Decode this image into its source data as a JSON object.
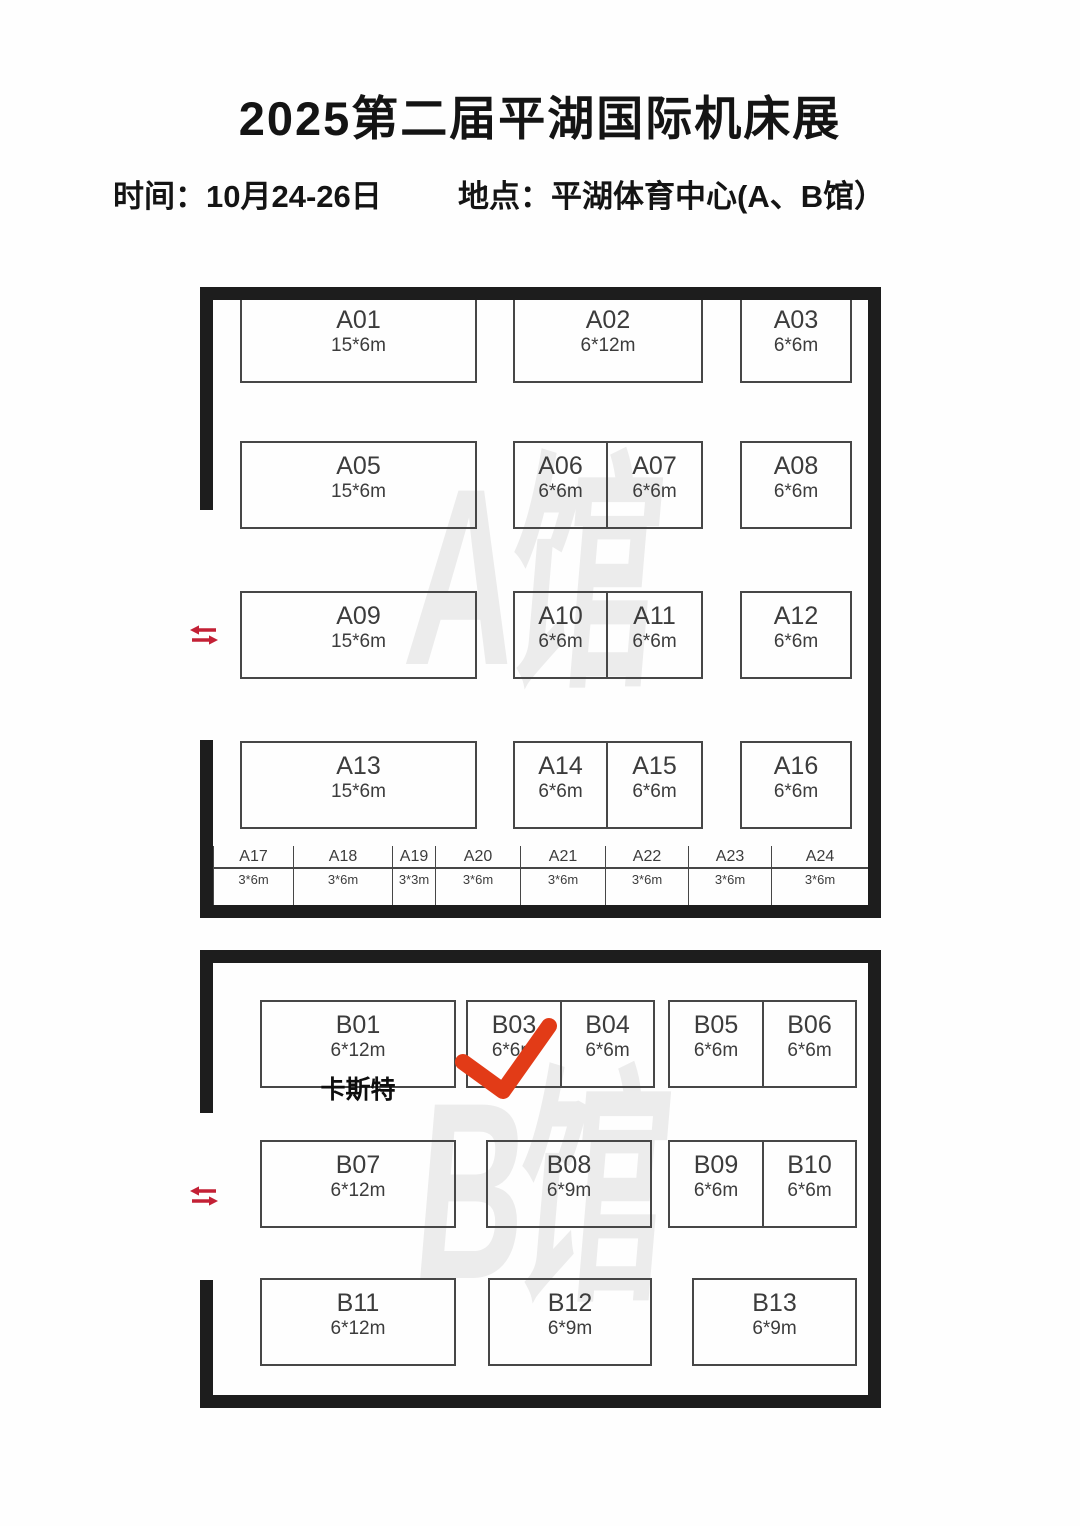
{
  "title": "2025第二届平湖国际机床展",
  "info": {
    "time": "时间：10月24-26日",
    "location": "地点：平湖体育中心(A、B馆）"
  },
  "colors": {
    "wall": "#1d1d1d",
    "booth_border": "#474747",
    "booth_text": "#3c3c3c",
    "watermark": "#ececec",
    "entrance_arrows": "#c32035",
    "checkmark": "#e23b17"
  },
  "annotations": {
    "checkmark_on_booth": "B03",
    "entrance_icon": "two-way-arrows"
  },
  "halls": [
    {
      "name": "A馆",
      "watermark": "A馆",
      "booths": [
        {
          "name": "A01",
          "size": "15*6m",
          "x": 240,
          "y": 295,
          "w": 237,
          "h": 88
        },
        {
          "name": "A02",
          "size": "6*12m",
          "x": 513,
          "y": 295,
          "w": 190,
          "h": 88
        },
        {
          "name": "A03",
          "size": "6*6m",
          "x": 740,
          "y": 295,
          "w": 112,
          "h": 88
        },
        {
          "name": "A05",
          "size": "15*6m",
          "x": 240,
          "y": 441,
          "w": 237,
          "h": 88
        },
        {
          "name": "A06",
          "size": "6*6m",
          "x": 513,
          "y": 441,
          "w": 95,
          "h": 88
        },
        {
          "name": "A07",
          "size": "6*6m",
          "x": 606,
          "y": 441,
          "w": 97,
          "h": 88
        },
        {
          "name": "A08",
          "size": "6*6m",
          "x": 740,
          "y": 441,
          "w": 112,
          "h": 88
        },
        {
          "name": "A09",
          "size": "15*6m",
          "x": 240,
          "y": 591,
          "w": 237,
          "h": 88
        },
        {
          "name": "A10",
          "size": "6*6m",
          "x": 513,
          "y": 591,
          "w": 95,
          "h": 88
        },
        {
          "name": "A11",
          "size": "6*6m",
          "x": 606,
          "y": 591,
          "w": 97,
          "h": 88
        },
        {
          "name": "A12",
          "size": "6*6m",
          "x": 740,
          "y": 591,
          "w": 112,
          "h": 88
        },
        {
          "name": "A13",
          "size": "15*6m",
          "x": 240,
          "y": 741,
          "w": 237,
          "h": 88
        },
        {
          "name": "A14",
          "size": "6*6m",
          "x": 513,
          "y": 741,
          "w": 95,
          "h": 88
        },
        {
          "name": "A15",
          "size": "6*6m",
          "x": 606,
          "y": 741,
          "w": 97,
          "h": 88
        },
        {
          "name": "A16",
          "size": "6*6m",
          "x": 740,
          "y": 741,
          "w": 112,
          "h": 88
        }
      ],
      "strip_booths": [
        {
          "name": "A17",
          "size": "3*6m",
          "x": 213,
          "w": 80
        },
        {
          "name": "A18",
          "size": "3*6m",
          "x": 293,
          "w": 99
        },
        {
          "name": "A19",
          "size": "3*3m",
          "x": 392,
          "w": 43
        },
        {
          "name": "A20",
          "size": "3*6m",
          "x": 435,
          "w": 85
        },
        {
          "name": "A21",
          "size": "3*6m",
          "x": 520,
          "w": 85
        },
        {
          "name": "A22",
          "size": "3*6m",
          "x": 605,
          "w": 83
        },
        {
          "name": "A23",
          "size": "3*6m",
          "x": 688,
          "w": 83
        },
        {
          "name": "A24",
          "size": "3*6m",
          "x": 771,
          "w": 97
        }
      ]
    },
    {
      "name": "B馆",
      "watermark": "B馆",
      "booths": [
        {
          "name": "B01",
          "size": "6*12m",
          "exhibitor": "卡斯特",
          "x": 260,
          "y": 1000,
          "w": 196,
          "h": 88
        },
        {
          "name": "B03",
          "size": "6*6m",
          "x": 466,
          "y": 1000,
          "w": 96,
          "h": 88
        },
        {
          "name": "B04",
          "size": "6*6m",
          "x": 560,
          "y": 1000,
          "w": 95,
          "h": 88
        },
        {
          "name": "B05",
          "size": "6*6m",
          "x": 668,
          "y": 1000,
          "w": 96,
          "h": 88
        },
        {
          "name": "B06",
          "size": "6*6m",
          "x": 762,
          "y": 1000,
          "w": 95,
          "h": 88
        },
        {
          "name": "B07",
          "size": "6*12m",
          "x": 260,
          "y": 1140,
          "w": 196,
          "h": 88
        },
        {
          "name": "B08",
          "size": "6*9m",
          "x": 486,
          "y": 1140,
          "w": 166,
          "h": 88
        },
        {
          "name": "B09",
          "size": "6*6m",
          "x": 668,
          "y": 1140,
          "w": 96,
          "h": 88
        },
        {
          "name": "B10",
          "size": "6*6m",
          "x": 762,
          "y": 1140,
          "w": 95,
          "h": 88
        },
        {
          "name": "B11",
          "size": "6*12m",
          "x": 260,
          "y": 1278,
          "w": 196,
          "h": 88
        },
        {
          "name": "B12",
          "size": "6*9m",
          "x": 488,
          "y": 1278,
          "w": 164,
          "h": 88
        },
        {
          "name": "B13",
          "size": "6*9m",
          "x": 692,
          "y": 1278,
          "w": 165,
          "h": 88
        }
      ]
    }
  ]
}
